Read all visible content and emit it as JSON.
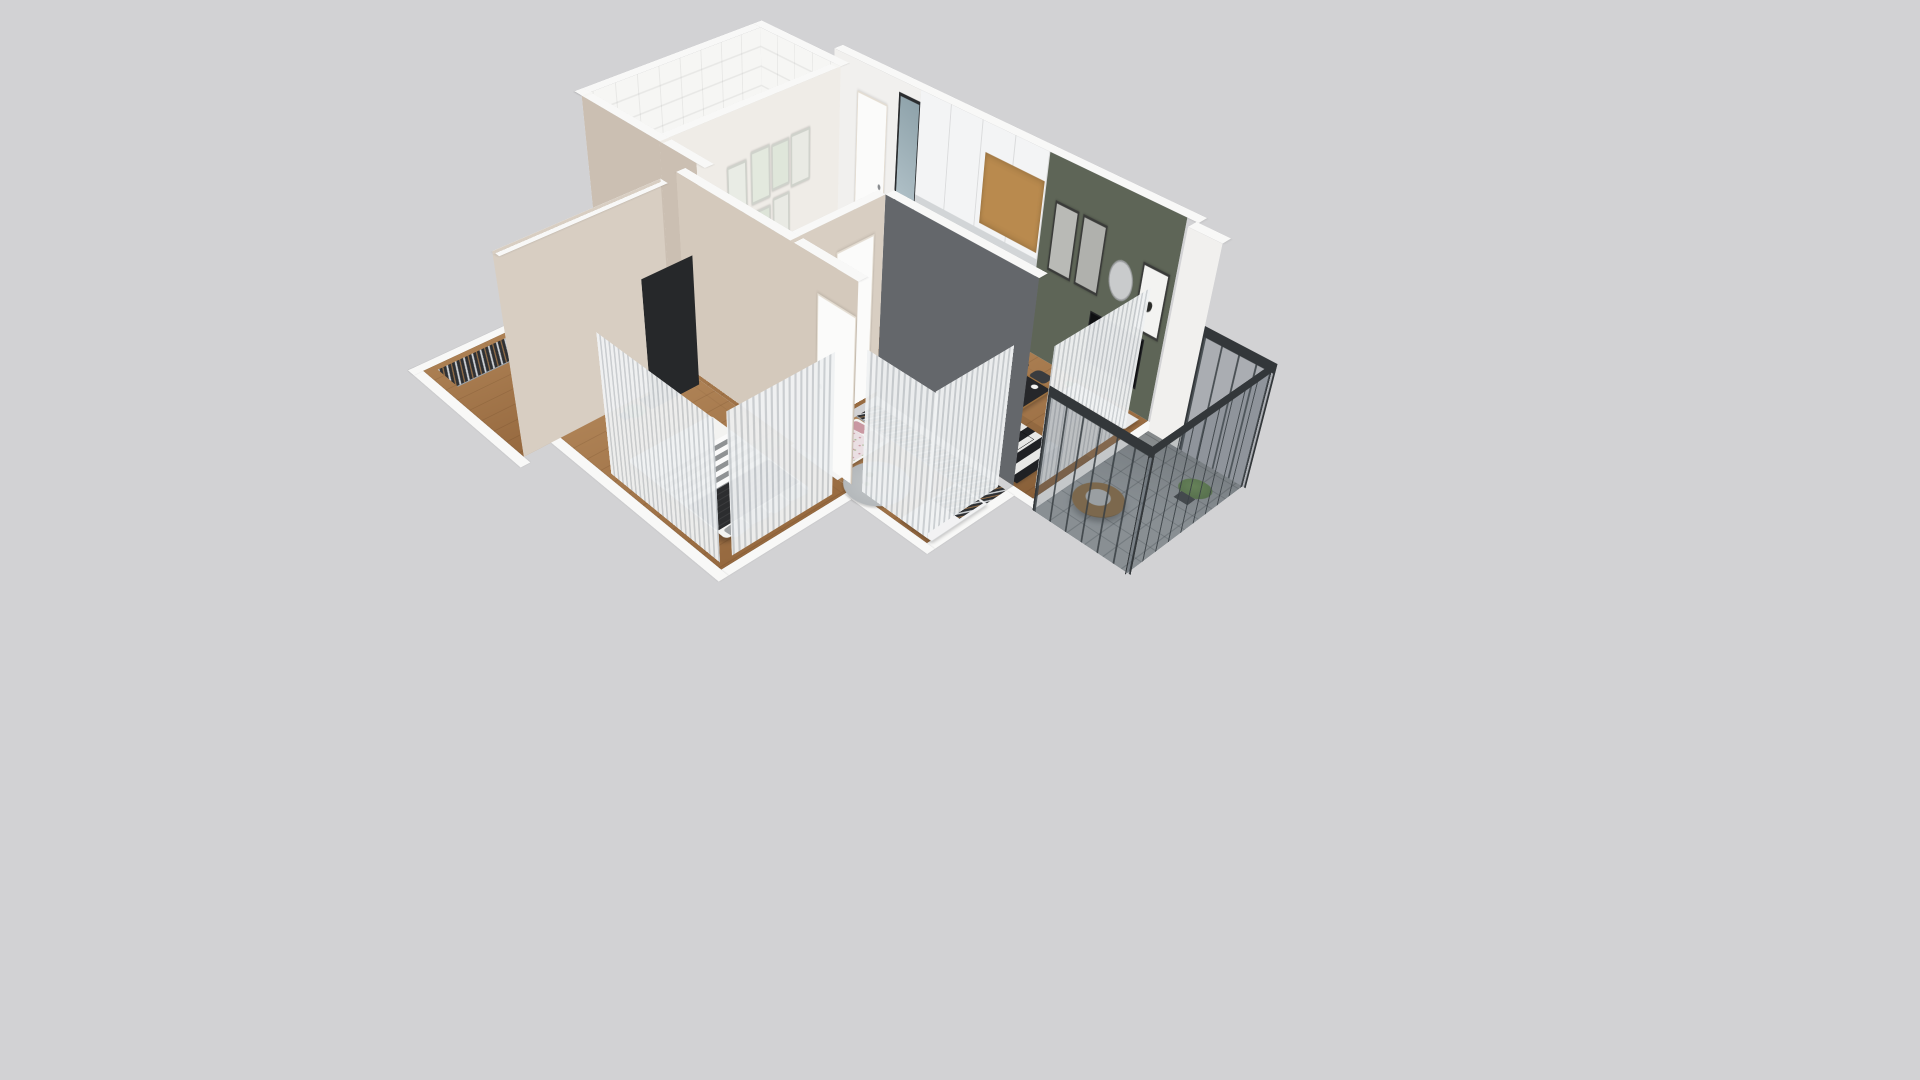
{
  "scene": {
    "description": "3D dollhouse-style axonometric rendering of a two-bedroom apartment floor plan on a plain light gray background, no text or UI controls visible",
    "view": "elevated angled top-down (bird's eye) view",
    "background": "#d2d2d4"
  },
  "palette": {
    "bg": "#d2d2d4",
    "wallTop": "#f8f8f7",
    "wallWhite": "#f1f0ee",
    "wallGreen": "#5e6557",
    "wallBeige": "#cbbfb2",
    "wallBeige2": "#d8cec2",
    "wallGray": "#64676b",
    "galleryWall": "#efece7",
    "floorWoodA": "#b08457",
    "floorWoodB": "#96693f",
    "floorTile": "#d9d5cd",
    "floorBath": "#f3f3f1",
    "floorBalcony": "#a0a5a7",
    "rugA": "#e8e8e6",
    "rugB": "#202124",
    "curtainA": "#f0f2f3",
    "curtainB": "#c9cdd0",
    "railDark": "#33373a",
    "railGlass": "rgba(88,98,106,0.32)",
    "tv": "#0f1012",
    "console": "#e9eaeb",
    "tableDark": "#26272a",
    "tableWood": "#9a6f3f",
    "chair": "#3a3c3f",
    "bedWhite": "#f3f3f1",
    "stripeGray": "#8f9294",
    "throwDark": "#2c2d2f",
    "pillowGray": "#9a9da0",
    "kidsDuvet": "#eadfe3",
    "pillowPink": "#c998a2",
    "pillowGreen": "#a9bb96",
    "salmon": "#d8a8a2",
    "closetDark": "#2e3033",
    "dresser": "#f3f3f2",
    "tub": "#fbfbfa",
    "slate": "#4a4d50",
    "mirror": "#aec2ca",
    "door": "#fbfbfa",
    "pouf": "#b4a89a",
    "plant": "#4f6e3b",
    "plantLight": "#6d9150",
    "rattan": "#8d6c3f",
    "shaft": "#97999c",
    "woodAccent": "#b98a4e"
  },
  "apartment": {
    "rooms": [
      {
        "id": "living-dining-kitchen",
        "accent_wall": "#5e6557",
        "furniture": [
          "kitchen-upper-cabinets",
          "cooktop",
          "oven",
          "coffee-machine",
          "dining-table",
          "dining-chairs",
          "plates",
          "fruit-bowl",
          "tv",
          "tv-console",
          "striped-rug",
          "glass-coffee-table",
          "wall-clock",
          "framed-art",
          "butterfly-art",
          "plant-pot"
        ],
        "dining_chair_count": 4,
        "wall_art_count": 3
      },
      {
        "id": "balcony",
        "furniture": [
          "hanging-egg-chair",
          "tall-potted-plant",
          "glass-metal-railing",
          "tile-floor"
        ]
      },
      {
        "id": "kids-bedroom",
        "furniture": [
          "single-bed",
          "floral-duvet",
          "pink-pillows",
          "wardrobe-clothes-rack",
          "white-wardrobe",
          "desk",
          "round-rug",
          "cacti-decor",
          "window-curtains"
        ]
      },
      {
        "id": "master-bedroom",
        "furniture": [
          "double-bed",
          "striped-blanket",
          "dark-throw",
          "gray-pillows",
          "dark-wardrobe-panel",
          "plant",
          "window-curtains"
        ]
      },
      {
        "id": "walk-in-closet",
        "furniture": [
          "clothes-rack-west",
          "clothes-rack-north",
          "white-dresser"
        ],
        "clothes_rack_count": 2
      },
      {
        "id": "bathroom",
        "furniture": [
          "bathtub",
          "shower-fixture",
          "glass-shower-panel",
          "toilet",
          "wall-shelves",
          "towels",
          "plant",
          "dotted-tile-floor"
        ]
      },
      {
        "id": "entry-hallway",
        "furniture": [
          "entry-door",
          "tall-mirror",
          "pouf",
          "gallery-wall-frames",
          "utility-shaft"
        ],
        "gallery_frame_count": 7
      }
    ]
  }
}
